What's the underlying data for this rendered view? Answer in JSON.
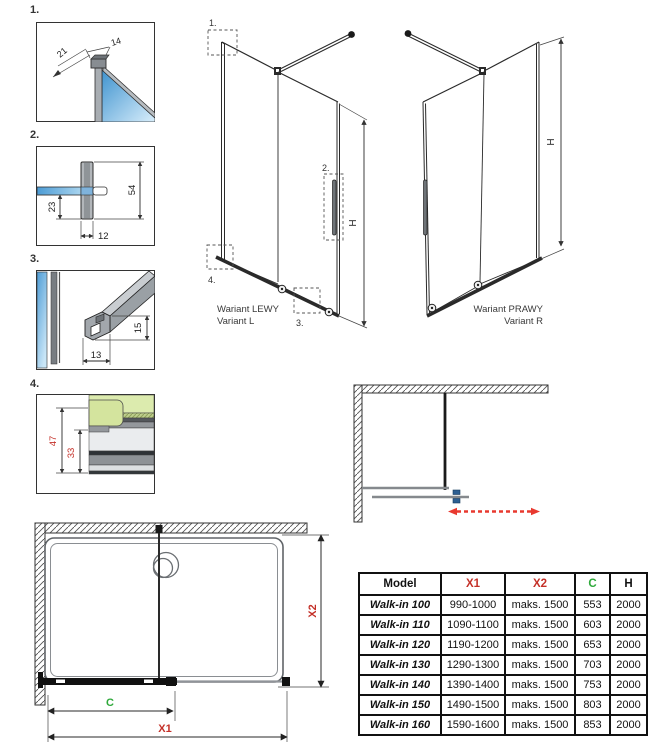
{
  "page": {
    "width": 660,
    "height": 750,
    "background": "#ffffff"
  },
  "colors": {
    "line": "#2a2a2a",
    "dim_red": "#c43028",
    "dim_green": "#2fa93b",
    "arrow_red": "#e8392f",
    "glass_blue": "#4f9dd6",
    "glass_blue_light": "#cfe9f8",
    "profile_gray": "#a8adb2",
    "glass_green": "#dcebae",
    "handle_blue": "#2d5f92"
  },
  "details": {
    "d1": {
      "label": "1.",
      "dim_top": "14",
      "dim_diag": "21"
    },
    "d2": {
      "label": "2.",
      "dim_height": "54",
      "dim_lower": "23",
      "dim_width": "12"
    },
    "d3": {
      "label": "3.",
      "dim_height": "15",
      "dim_width": "13"
    },
    "d4": {
      "label": "4.",
      "dim_outer": "47",
      "dim_inner": "33"
    }
  },
  "variants": {
    "left": {
      "title": "Wariant LEWY",
      "subtitle": "Variant L",
      "dim_h": "H",
      "callout1": "1.",
      "callout2": "2.",
      "callout3": "3.",
      "callout4": "4."
    },
    "right": {
      "title": "Wariant PRAWY",
      "subtitle": "Variant R",
      "dim_h": "H"
    }
  },
  "plan": {
    "dim_x1": "X1",
    "dim_x2": "X2",
    "dim_c": "C"
  },
  "table": {
    "headers": [
      "Model",
      "X1",
      "X2",
      "C",
      "H"
    ],
    "rows": [
      {
        "model": "Walk-in 100",
        "x1": "990-1000",
        "x2": "maks. 1500",
        "c": "553",
        "h": "2000"
      },
      {
        "model": "Walk-in 110",
        "x1": "1090-1100",
        "x2": "maks. 1500",
        "c": "603",
        "h": "2000"
      },
      {
        "model": "Walk-in 120",
        "x1": "1190-1200",
        "x2": "maks. 1500",
        "c": "653",
        "h": "2000"
      },
      {
        "model": "Walk-in 130",
        "x1": "1290-1300",
        "x2": "maks. 1500",
        "c": "703",
        "h": "2000"
      },
      {
        "model": "Walk-in 140",
        "x1": "1390-1400",
        "x2": "maks. 1500",
        "c": "753",
        "h": "2000"
      },
      {
        "model": "Walk-in 150",
        "x1": "1490-1500",
        "x2": "maks. 1500",
        "c": "803",
        "h": "2000"
      },
      {
        "model": "Walk-in 160",
        "x1": "1590-1600",
        "x2": "maks. 1500",
        "c": "853",
        "h": "2000"
      }
    ]
  }
}
